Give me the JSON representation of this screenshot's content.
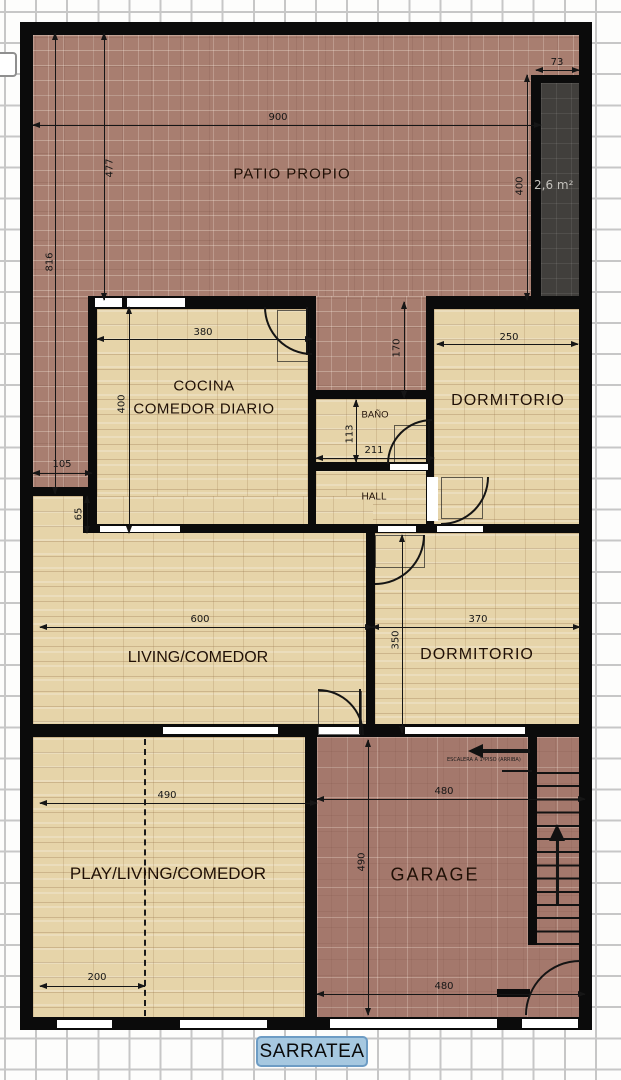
{
  "badge": {
    "label": "SARRATEA"
  },
  "rooms": {
    "patio": "PATIO PROPIO",
    "cocina_1": "COCINA",
    "cocina_2": "COMEDOR DIARIO",
    "bano": "BAÑO",
    "hall": "HALL",
    "dorm1": "DORMITORIO",
    "dorm2": "DORMITORIO",
    "living": "LIVING/COMEDOR",
    "play": "PLAY/LIVING/COMEDOR",
    "garage": "GARAGE"
  },
  "dims": {
    "patio_w": "900",
    "patio_h": "816",
    "patio_inner_h": "477",
    "closet_w": "73",
    "closet_h": "400",
    "passage_h": "170",
    "cocina_w": "380",
    "cocina_h": "400",
    "patio_side_w": "105",
    "step_h": "65",
    "dorm1_w": "250",
    "bano_h": "113",
    "bano_w": "211",
    "living_w": "600",
    "dorm2_w": "370",
    "dorm2_h": "350",
    "play_w": "490",
    "garage_w_top": "480",
    "garage_h": "490",
    "garage_w_bottom": "480",
    "play_inner_w": "200"
  },
  "annotations": {
    "closet_area": "2,6 m²",
    "stairs_note": "ESCALERA A 1ºPISO (ARRIBA)"
  },
  "colors": {
    "wall": "#0b0b0b",
    "patio_brick": "#a87e70",
    "garage_brick": "#a4786c",
    "floor_tile": "#e6d4a9",
    "closet_dark": "#413f3c",
    "badge_fill": "#a6c8e0",
    "badge_border": "#6d9cc4",
    "grid": "#c7c7c7"
  }
}
